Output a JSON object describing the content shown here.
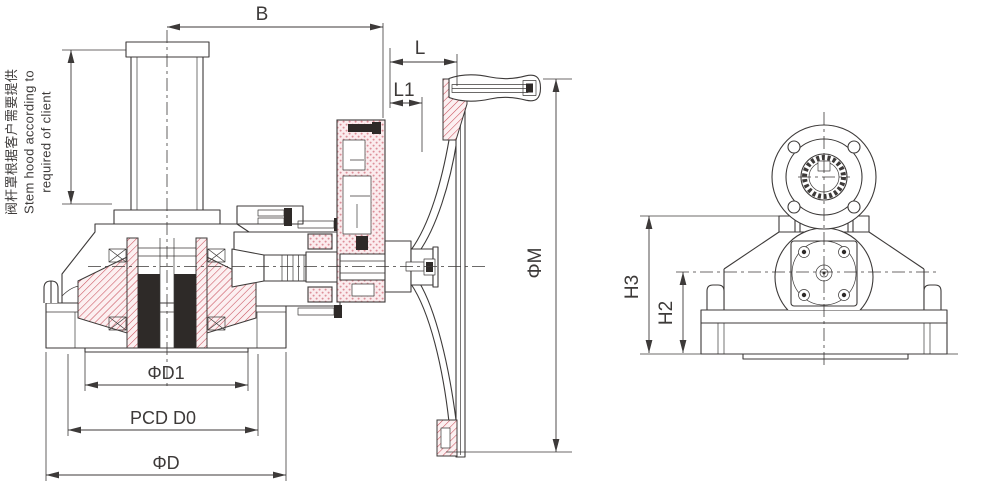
{
  "note": {
    "line1": "阀杆罩根据客户需要提供",
    "line2": "Stem hood according to",
    "line3": "required of client"
  },
  "dims": {
    "b": "B",
    "l": "L",
    "l1": "L1",
    "phi_m": "ΦM",
    "phi_d1": "ΦD1",
    "pcd_d0": "PCD D0",
    "phi_d": "ΦD",
    "h3": "H3",
    "h2": "H2"
  },
  "colors": {
    "line": "#3d3a39",
    "dim": "#3d3a39",
    "hatch": "#c9505c",
    "hatchbg": "#fcf0f1",
    "dots": "#dd8f99",
    "dotsbg": "#fbecee",
    "solid": "#2e2a28",
    "bg": "#ffffff"
  }
}
